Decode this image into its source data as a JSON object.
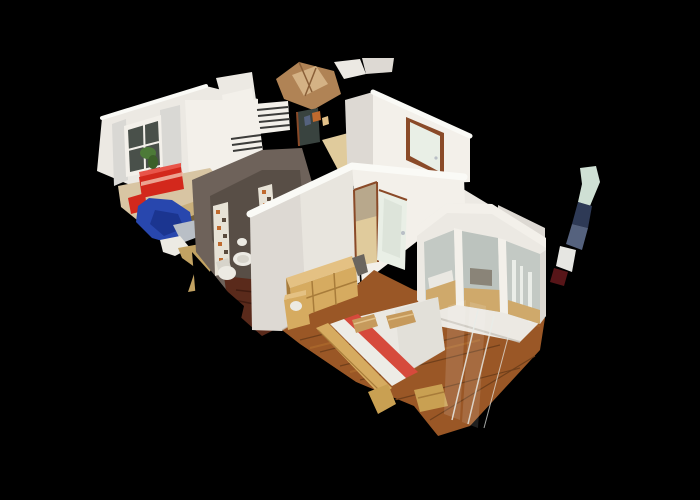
{
  "scene": {
    "view": "dollhouse-3d-cutaway",
    "rooms": [
      "living-room",
      "kitchen",
      "hallway",
      "bathroom",
      "bedroom",
      "entry"
    ],
    "objects": [
      "window-with-plant",
      "curtains",
      "red-sideboard",
      "blue-chair",
      "radiator",
      "entry-door",
      "mosaic-tile-strip",
      "toilet",
      "bidet",
      "bedroom-door-frosted-glass",
      "pine-dresser",
      "nightstand",
      "double-bed-white-duvet-red-stripe",
      "pillows",
      "headboard",
      "mirrored-wardrobe",
      "glass-panels",
      "wood-floor",
      "scan-artifact-sliver"
    ]
  },
  "colors": {
    "background": "#000000",
    "wall_white": "#ece9e3",
    "wall_bright": "#f3f0ea",
    "wall_shaded": "#ddd9d3",
    "wall_edge": "#fafaf6",
    "wall_gap": "#c9c4bc",
    "curtain": "#d9d8d4",
    "window_pane": "#49504a",
    "plant_green": "#4d7a38",
    "plant_green_dark": "#3c6029",
    "pot_brown": "#59372c",
    "red_furniture": "#d3281c",
    "red_furniture_light": "#e8554a",
    "pink_stripe": "#f0b9a6",
    "blue_chair": "#2847ae",
    "blue_chair_dark": "#1b3590",
    "gray_seat": "#b9bfc6",
    "floor_beige": "#d8c5a3",
    "gold_patch": "#c2a262",
    "wood_tan": "#b08355",
    "wood_tan_light": "#d4b285",
    "wood_tan_dark": "#8a5f38",
    "radiator_slat": "#3c3c3a",
    "doorway_dark": "#39433f",
    "door_trim": "#8a4a28",
    "door_panel": "#e9efe6",
    "door_glass": "#dde4da",
    "hall_floor": "#e0cb9c",
    "hall_shadow": "#b8a88c",
    "bath_wall": "#6e625a",
    "bath_wall_dark": "#554b43",
    "mosaic_base": "#e7e2d6",
    "mosaic_orange": "#c06a2e",
    "mosaic_dark": "#5a4a3c",
    "fixture_white": "#eceae3",
    "fixture_shadow": "#d7d4cb",
    "bath_floor": "#5a2a1b",
    "bath_floor_dark": "#401b10",
    "wood_floor": "#9a5726",
    "wood_floor_dark": "#71401b",
    "wood_floor_light": "#b5722f",
    "duvet_white": "#eae8e2",
    "duvet_shade": "#d9d7cf",
    "bed_stripe_red": "#d64a3c",
    "sheet_white": "#edece6",
    "pillow_tan": "#c69a5c",
    "pillow_light": "#e2c189",
    "pine_wood": "#d6ab60",
    "pine_dark": "#a87c3a",
    "pine_top": "#e4c183",
    "mirror_gray": "#c3c9c4",
    "mirror_gray2": "#bcc3be",
    "mirror_warm": "#cfa96b",
    "mirror_dark": "#8a8478",
    "mirror_bright": "#eef1ec",
    "glass_edge": "#e9ede9",
    "bench_gold": "#c9a052",
    "dark_item": "#6a655e",
    "artifact_mint": "#cfe0d4",
    "artifact_navy": "#2e3a56",
    "artifact_blue": "#55627e",
    "artifact_white": "#e6e6e2",
    "artifact_red": "#571518"
  }
}
